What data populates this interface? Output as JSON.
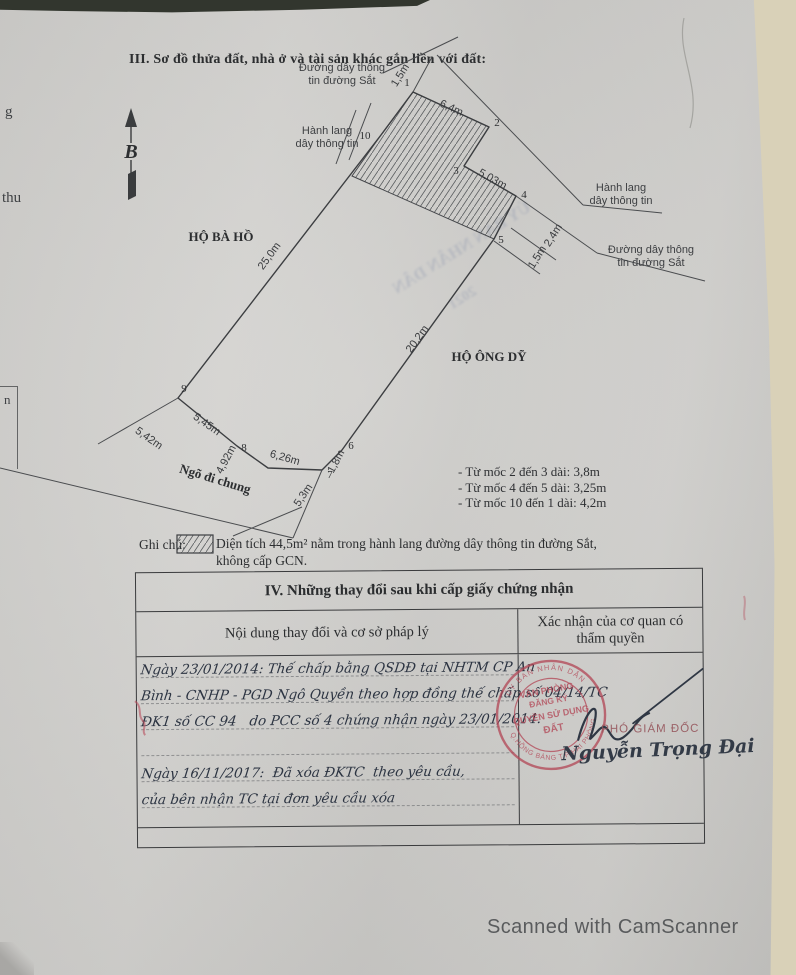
{
  "page": {
    "section3_title": "III. Sơ đồ thửa đất, nhà ở và tài sản khác gắn liền với đất:",
    "footer": "Scanned with CamScanner"
  },
  "diagram": {
    "compass": {
      "label": "B",
      "x": 131,
      "y": 158
    },
    "plot_points": [
      [
        413,
        92
      ],
      [
        489,
        127
      ],
      [
        464,
        166
      ],
      [
        516,
        196
      ],
      [
        494,
        239
      ],
      [
        342,
        450
      ],
      [
        322,
        470
      ],
      [
        268,
        468
      ],
      [
        237,
        446
      ],
      [
        178,
        398
      ],
      [
        381,
        135
      ]
    ],
    "hatch_points": [
      [
        381,
        135
      ],
      [
        413,
        92
      ],
      [
        489,
        127
      ],
      [
        464,
        166
      ],
      [
        516,
        196
      ],
      [
        494,
        239
      ],
      [
        352,
        176
      ]
    ],
    "aux_lines": [
      [
        383,
        73,
        458,
        37
      ],
      [
        413,
        92,
        432,
        57
      ],
      [
        437,
        55,
        583,
        205
      ],
      [
        583,
        205,
        662,
        213
      ],
      [
        516,
        196,
        597,
        253
      ],
      [
        597,
        253,
        705,
        281
      ],
      [
        494,
        241,
        540,
        274
      ],
      [
        511,
        228,
        556,
        260
      ],
      [
        371,
        103,
        349,
        160
      ],
      [
        356,
        110,
        336,
        164
      ],
      [
        178,
        398,
        98,
        444
      ],
      [
        0,
        468,
        293,
        538
      ],
      [
        322,
        470,
        293,
        538
      ],
      [
        233,
        536,
        302,
        507
      ]
    ],
    "vertex_markers": [
      {
        "n": "1",
        "x": 407,
        "y": 86
      },
      {
        "n": "2",
        "x": 497,
        "y": 126
      },
      {
        "n": "3",
        "x": 456,
        "y": 174
      },
      {
        "n": "4",
        "x": 524,
        "y": 198
      },
      {
        "n": "5",
        "x": 501,
        "y": 243
      },
      {
        "n": "6",
        "x": 351,
        "y": 449
      },
      {
        "n": "7",
        "x": 330,
        "y": 478
      },
      {
        "n": "8",
        "x": 244,
        "y": 451
      },
      {
        "n": "9",
        "x": 184,
        "y": 392
      },
      {
        "n": "10",
        "x": 365,
        "y": 139
      }
    ],
    "dim_labels": [
      {
        "t": "25,0m",
        "x": 272,
        "y": 258,
        "r": -54
      },
      {
        "t": "20,2m",
        "x": 420,
        "y": 341,
        "r": -54
      },
      {
        "t": "6,4m",
        "x": 450,
        "y": 111,
        "r": 25
      },
      {
        "t": "5,03m",
        "x": 491,
        "y": 182,
        "r": 29
      },
      {
        "t": "5,45m",
        "x": 205,
        "y": 427,
        "r": 35
      },
      {
        "t": "4,92m",
        "x": 229,
        "y": 461,
        "r": -62
      },
      {
        "t": "6,26m",
        "x": 284,
        "y": 461,
        "r": 16
      },
      {
        "t": "1,8m",
        "x": 339,
        "y": 463,
        "r": -62
      },
      {
        "t": "5,3m",
        "x": 306,
        "y": 497,
        "r": -56
      },
      {
        "t": "5,42m",
        "x": 147,
        "y": 441,
        "r": 35
      },
      {
        "t": "1,5m",
        "x": 540,
        "y": 259,
        "r": -58
      },
      {
        "t": "2,4m",
        "x": 556,
        "y": 237,
        "r": -58
      },
      {
        "t": "1,5m",
        "x": 403,
        "y": 77,
        "r": -58
      }
    ],
    "area_labels": [
      {
        "t": "HỘ BÀ HỒ",
        "x": 221,
        "y": 241,
        "r": 0
      },
      {
        "t": "HỘ ÔNG DỸ",
        "x": 489,
        "y": 361,
        "r": 0
      },
      {
        "t": "Ngõ đi chung",
        "x": 214,
        "y": 483,
        "r": 17
      }
    ],
    "corridor_labels": [
      {
        "l1": "Đường dây thông",
        "l2": "tin đường Sắt",
        "x": 342,
        "y": 71
      },
      {
        "l1": "Hành lang",
        "l2": "dây thông tin",
        "x": 327,
        "y": 134
      },
      {
        "l1": "Hành lang",
        "l2": "dây thông tin",
        "x": 621,
        "y": 191
      },
      {
        "l1": "Đường dây thông",
        "l2": "tin đường Sắt",
        "x": 651,
        "y": 253
      }
    ],
    "notes": [
      "- Từ mốc 2 đến 3 dài: 3,8m",
      "- Từ mốc 4 đến 5 dài: 3,25m",
      "- Từ mốc 10 đến 1 dài: 4,2m"
    ],
    "legend": {
      "label": "Ghi chú:",
      "line1": "Diện tích 44,5m² nằm trong hành lang đường dây thông tin đường Sắt,",
      "line2": "không cấp GCN."
    }
  },
  "table": {
    "title": "IV. Những thay đổi sau khi cấp giấy chứng nhận",
    "col1_header": "Nội dung thay đổi và cơ sở pháp lý",
    "col2_header": "Xác nhận của cơ quan có thẩm quyền",
    "entries": [
      {
        "lines": [
          "Ngày 23/01/2014: Thế chấp bằng QSDĐ tại NHTM CP An",
          "Bình - CNHP - PGD Ngô Quyền theo hợp đồng thế chấp số 04/14/TC",
          "ĐK1 số CC 94   do PCC số 4 chứng nhận ngày 23/01/2014."
        ]
      },
      {
        "lines": [
          "Ngày 16/11/2017:  Đã xóa ĐKTC  theo yêu cầu,",
          "của bên nhận TC tại đơn yêu cầu xóa"
        ]
      }
    ],
    "stamp": {
      "ring_top": "ỦY BAN NHÂN DÂN",
      "ring_bottom": "Q.HỒNG BÀNG T.P HẢI PHÒNG",
      "center_lines": [
        "VĂN PHÒNG",
        "ĐĂNG KÝ",
        "QUYỀN SỬ DỤNG",
        "ĐẤT"
      ]
    },
    "signature": {
      "title": "PHÓ GIÁM ĐỐC",
      "name": "Nguyễn Trọng Đại"
    }
  },
  "artifacts": {
    "bleed1": "ỦY BAN NHÂN DÂN",
    "bleed2": "2021",
    "edge_fragments": {
      "f1": "g",
      "f2": "thu",
      "f3": "n"
    }
  }
}
